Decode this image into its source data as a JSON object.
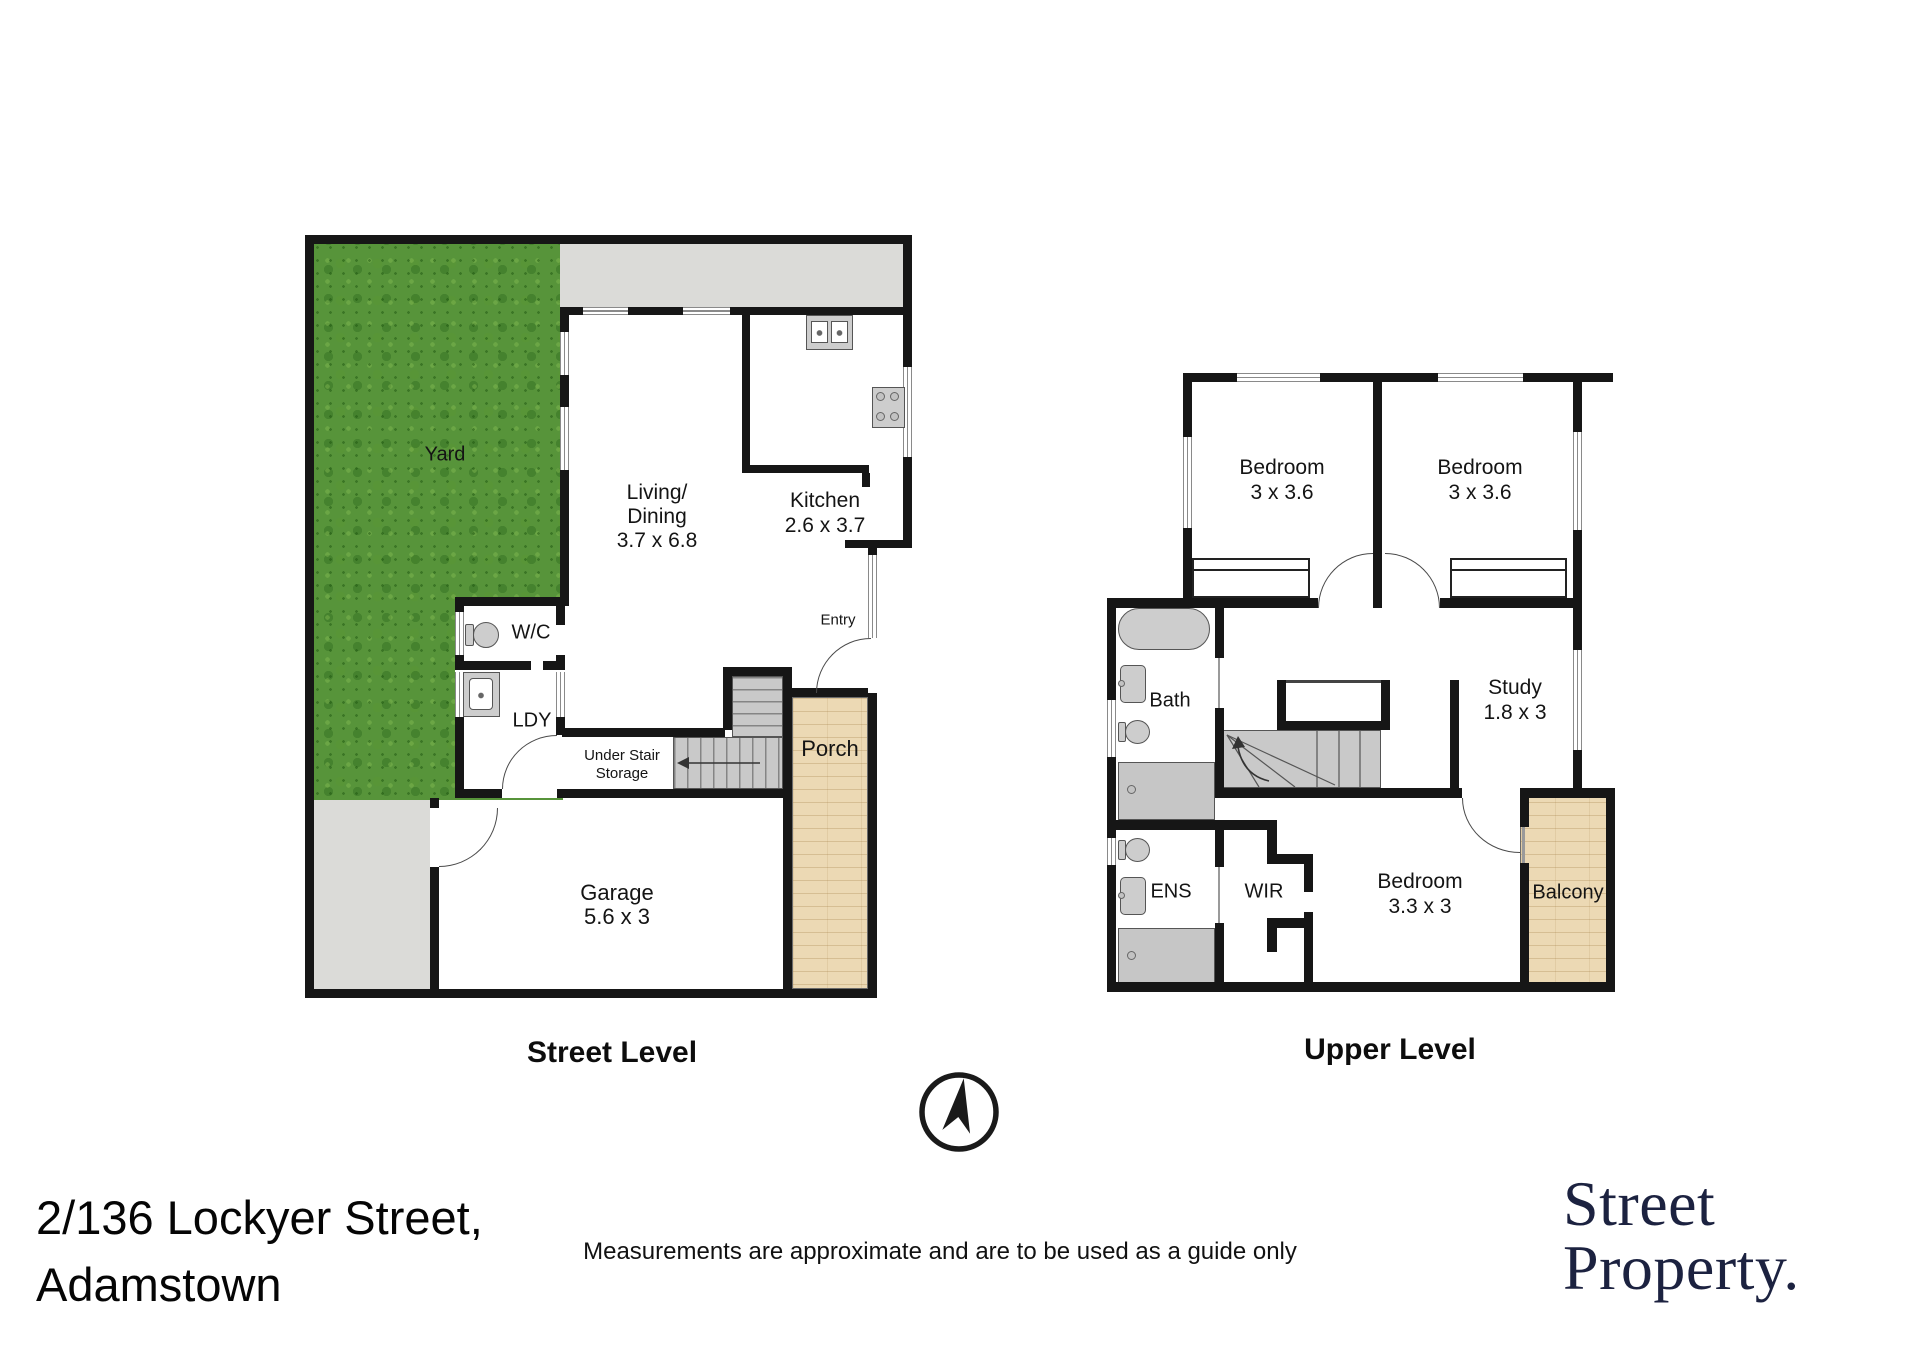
{
  "street_level": {
    "title": "Street Level",
    "rooms": {
      "yard": {
        "label": "Yard"
      },
      "living": {
        "line1": "Living/",
        "line2": "Dining",
        "dims": "3.7 x 6.8"
      },
      "kitchen": {
        "label": "Kitchen",
        "dims": "2.6 x 3.7"
      },
      "wc": {
        "label": "W/C"
      },
      "ldy": {
        "label": "LDY"
      },
      "entry": {
        "label": "Entry"
      },
      "under_stair": {
        "line1": "Under Stair",
        "line2": "Storage"
      },
      "porch": {
        "label": "Porch"
      },
      "garage": {
        "label": "Garage",
        "dims": "5.6 x 3"
      }
    }
  },
  "upper_level": {
    "title": "Upper Level",
    "rooms": {
      "bedroom1": {
        "label": "Bedroom",
        "dims": "3 x 3.6"
      },
      "bedroom2": {
        "label": "Bedroom",
        "dims": "3 x 3.6"
      },
      "bath": {
        "label": "Bath"
      },
      "study": {
        "label": "Study",
        "dims": "1.8 x 3"
      },
      "ens": {
        "label": "ENS"
      },
      "wir": {
        "label": "WIR"
      },
      "bedroom3": {
        "label": "Bedroom",
        "dims": "3.3 x 3"
      },
      "balcony": {
        "label": "Balcony"
      }
    }
  },
  "footer": {
    "address_line1": "2/136 Lockyer Street,",
    "address_line2": "Adamstown",
    "disclaimer": "Measurements are approximate and are to be used as a guide only",
    "logo_line1": "Street",
    "logo_line2": "Property."
  },
  "icons": {
    "compass": "north-compass-icon"
  },
  "colors": {
    "wall": "#161616",
    "grass": "#57943a",
    "concrete": "#dbdbd8",
    "wood": "#ecd9b4",
    "stair": "#c9c9c9",
    "fixture": "#cdcdcd",
    "logo": "#1c2240"
  }
}
